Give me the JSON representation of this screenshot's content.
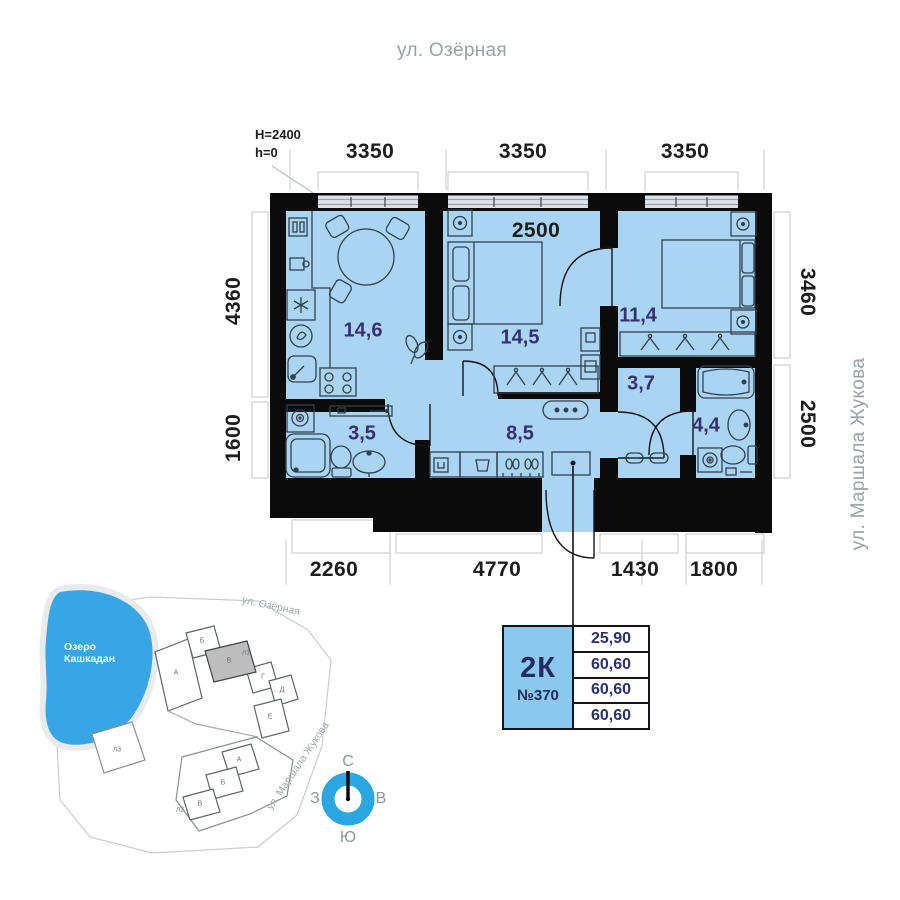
{
  "streets": {
    "top": "ул. Озёрная",
    "right": "ул. Маршала Жукова"
  },
  "plan": {
    "note1": "H=2400",
    "note2": "h=0",
    "dims_top": [
      "3350",
      "3350",
      "3350"
    ],
    "dims_bottom": [
      "2260",
      "4770",
      "1430",
      "1800"
    ],
    "dims_left": [
      "4360",
      "1600"
    ],
    "dims_right": [
      "3460",
      "2500"
    ],
    "dim_inner": "2500",
    "areas": {
      "kitchen": "14,6",
      "bedroom1": "14,5",
      "bedroom2": "11,4",
      "hall": "8,5",
      "bathroom1": "3,5",
      "corridor": "3,7",
      "bathroom2": "4,4"
    }
  },
  "info_card": {
    "type": "2К",
    "number": "№370",
    "values": [
      "25,90",
      "60,60",
      "60,60",
      "60,60"
    ]
  },
  "site_map": {
    "lake": [
      "Озеро",
      "Кашкадан"
    ],
    "street_top": "ул. Озёрная",
    "street_right": "ул. Маршала Жукова",
    "c1": [
      "А",
      "Б",
      "В",
      "Г",
      "Д",
      "Е"
    ],
    "c1_label": "л1",
    "c2": [
      "А",
      "Б",
      "В"
    ],
    "c2_label": "л2",
    "c3_label": "л3"
  },
  "compass": {
    "n": "С",
    "s": "Ю",
    "w": "З",
    "e": "В"
  },
  "colors": {
    "room_fill": "#A9D4F2",
    "wall": "#0B0B0C",
    "accent_blue": "#8CC7EF",
    "lake": "#38A5E5",
    "compass_ring": "#2AA7E0",
    "area_text": "#38306E",
    "dim_text": "#1D1D1F",
    "ghost_line": "#CDD0D4",
    "street_text": "#9AA1A7"
  }
}
